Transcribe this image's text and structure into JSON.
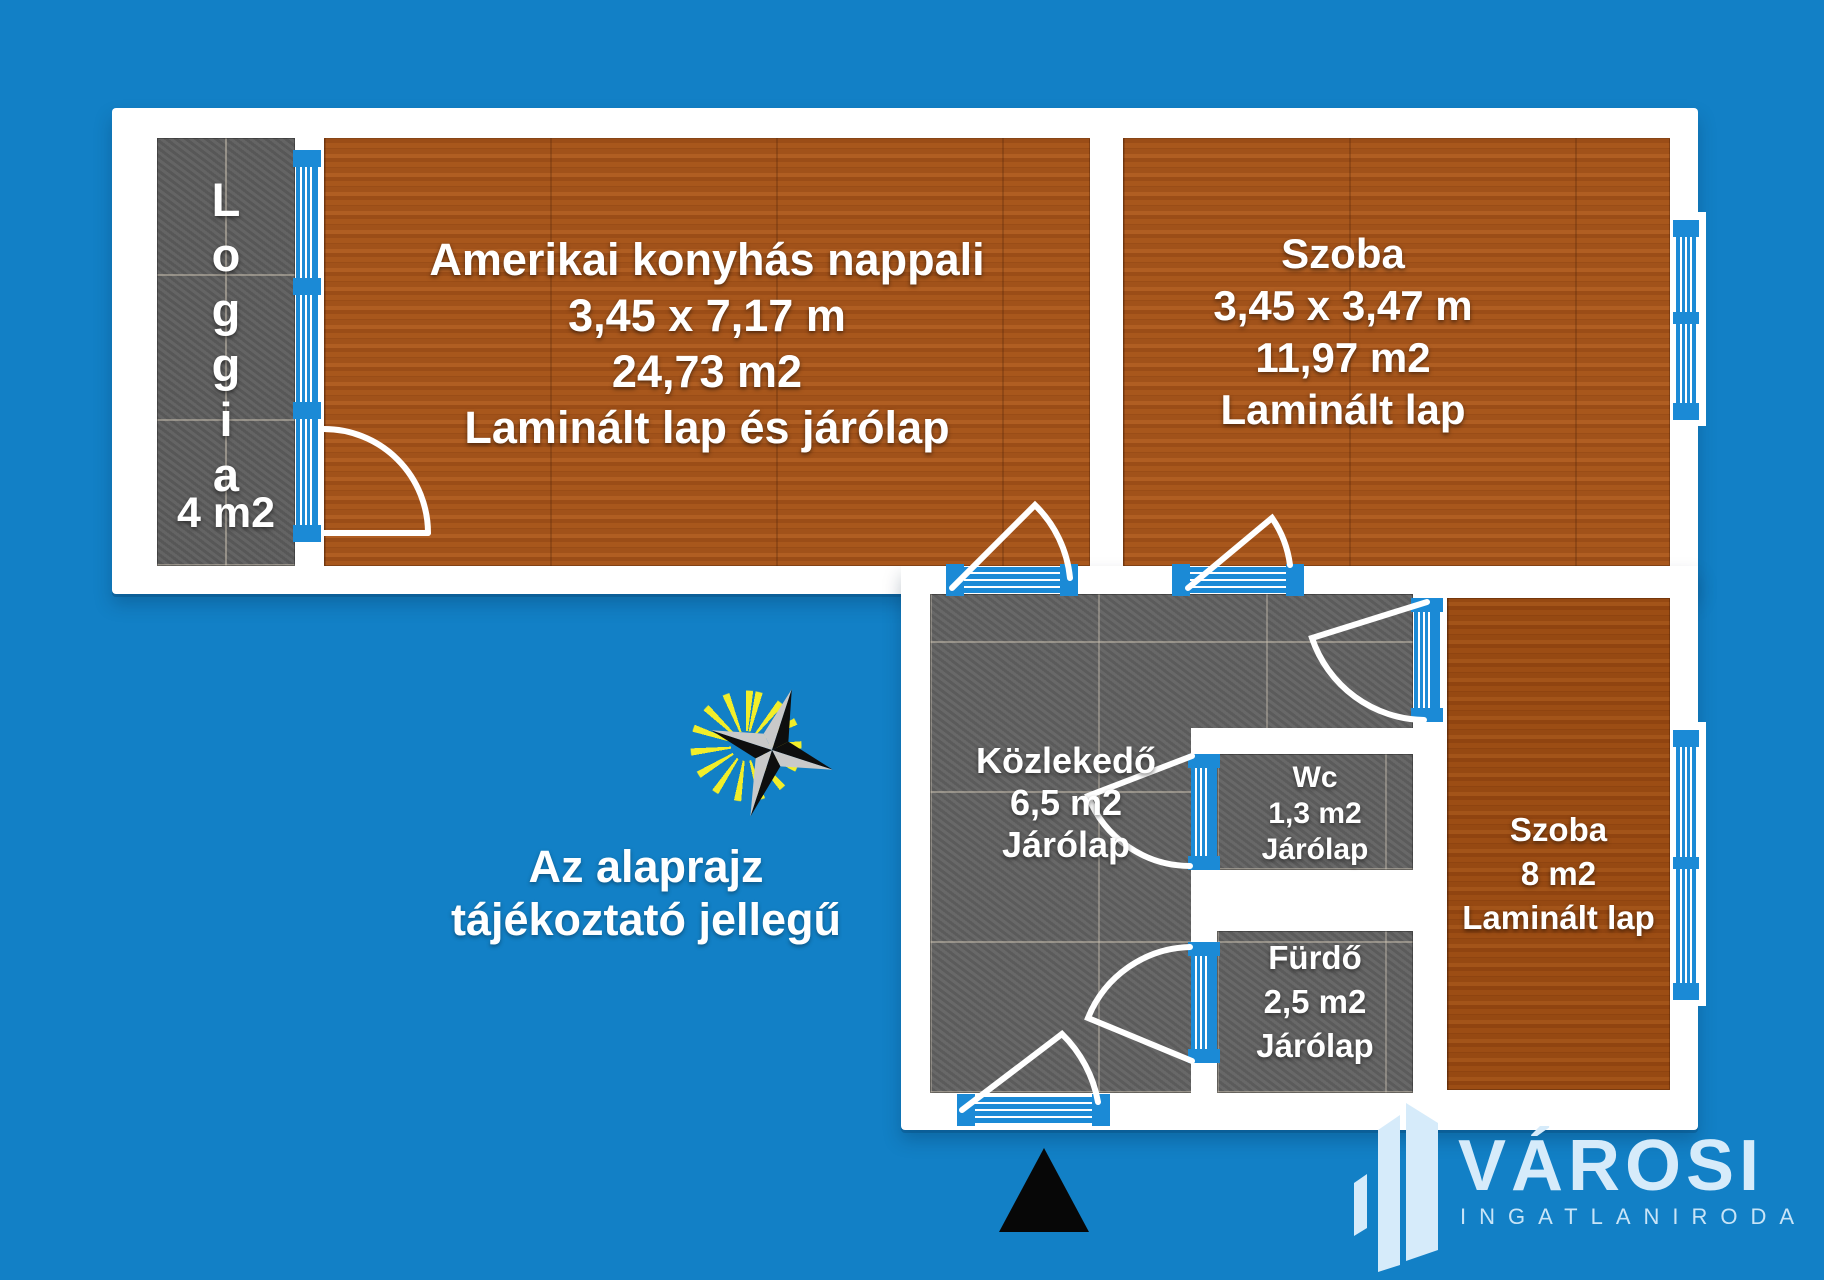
{
  "title": "Apartment floor plan",
  "colors": {
    "background": "#1280c6",
    "glass_blue": "#1b8ad6",
    "wall_white": "#ffffff",
    "wood_floor": "#a0521b",
    "tile_gray": "#616161",
    "logo_blue": "#d6ebfa",
    "ray_yellow": "#f2ee2a",
    "north_arrow": "#070707"
  },
  "rooms": {
    "loggia": {
      "name": "Loggia",
      "letters": [
        "L",
        "o",
        "g",
        "g",
        "i",
        "a"
      ],
      "area": "4 m2"
    },
    "living_room": {
      "name": "Amerikai konyhás nappali",
      "dimensions": "3,45 x 7,17 m",
      "area": "24,73 m2",
      "flooring": "Laminált lap és járólap"
    },
    "bedroom_top": {
      "name": "Szoba",
      "dimensions": "3,45 x 3,47 m",
      "area": "11,97  m2",
      "flooring": "Laminált lap"
    },
    "hallway": {
      "name": "Közlekedő",
      "area": "6,5 m2",
      "flooring": "Járólap"
    },
    "wc": {
      "name": "Wc",
      "area": "1,3  m2",
      "flooring": "Járólap"
    },
    "bathroom": {
      "name": "Fürdő",
      "area": "2,5 m2",
      "flooring": "Járólap"
    },
    "bedroom_right": {
      "name": "Szoba",
      "area": "8 m2",
      "flooring": "Laminált lap"
    }
  },
  "disclaimer": {
    "line1": "Az alaprajz",
    "line2": "tájékoztató jellegű"
  },
  "logo": {
    "brand": "VÁROSI",
    "subtitle": "INGATLANIRODA"
  }
}
